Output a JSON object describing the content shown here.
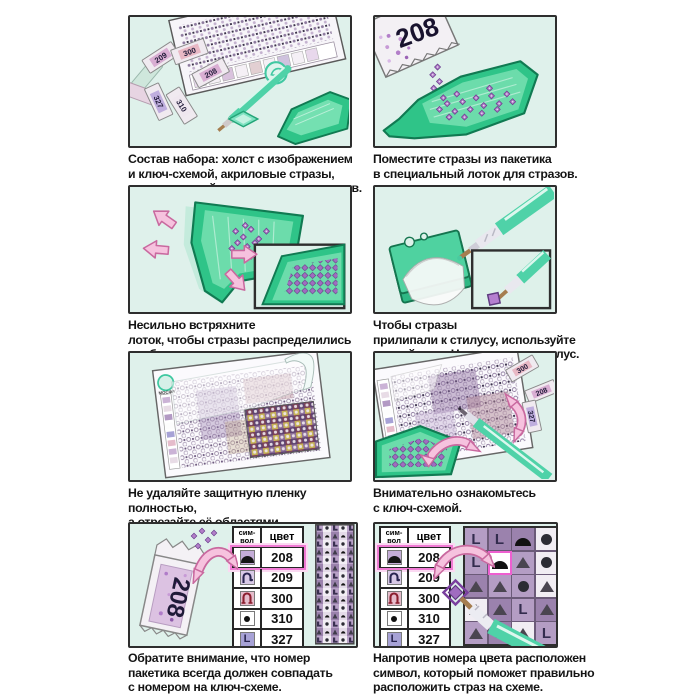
{
  "brand": "МОСФА",
  "panels": {
    "kit": {
      "caption": "Состав набора: холст с изображением\nи ключ-схемой, акриловые стразы,\nстилус, липкий гель, лоток для стразов."
    },
    "pour": {
      "caption": "Поместите стразы из пакетика\nв специальный лоток для стразов.",
      "packet_label": "208"
    },
    "shake": {
      "caption": "Несильно встряхните\nлоток, чтобы стразы распределились\nудобными рядами."
    },
    "gel": {
      "caption": "Чтобы стразы\nприлипали к стилусу, используйте\nлипкий гель. Наполните им стилус."
    },
    "film": {
      "caption": "Не удаляйте защитную пленку полностью,\nа отрезайте её областями.\nТак липкий слой прослужит дольше."
    },
    "study": {
      "caption": "Внимательно ознакомьтесь\nс ключ-схемой."
    },
    "match_number": {
      "caption": "Обратите внимание, что номер\nпакетика всегда должен совпадать\nс номером на ключ-схеме.",
      "packet_label": "208"
    },
    "place_symbol": {
      "caption": "Напротив номера цвета расположен\nсимвол, который поможет правильно\nрасположить страз на схеме."
    }
  },
  "kit_packets": [
    "209",
    "300",
    "208",
    "327",
    "310"
  ],
  "study_packets": [
    "300",
    "208",
    "327"
  ],
  "key_table": {
    "header_symbol": "сим-\nвол",
    "header_color": "цвет",
    "rows": [
      {
        "code": "208",
        "symbol": "dome-icon",
        "highlighted": true
      },
      {
        "code": "209",
        "symbol": "hook-icon",
        "highlighted": false
      },
      {
        "code": "300",
        "symbol": "arch-icon",
        "highlighted": false
      },
      {
        "code": "310",
        "symbol": "dot-icon",
        "highlighted": false
      },
      {
        "code": "327",
        "symbol": "letter-L",
        "letter": "L",
        "highlighted": false
      }
    ]
  },
  "schema_grid": {
    "cells": [
      [
        "L:m1",
        "L:m2",
        "dome:m2",
        "dot:w"
      ],
      [
        "L:m1",
        "dome:hl",
        "tri:m1",
        "dot:w"
      ],
      [
        "tri:m2",
        "tri:m1",
        "dot:m1",
        "tri:w"
      ],
      [
        "tri:w",
        "tri:m2",
        "L:m1",
        "tri:m2"
      ],
      [
        "tri:m1",
        "L:m2",
        "tri:w",
        "L:m1"
      ]
    ]
  },
  "colors": {
    "panel_bg": "#dff1eb",
    "tray_green": "#2fc488",
    "stylus_teal": "#4fd2a8",
    "crystal_purple": "#b37fc9",
    "highlight_pink": "#f07ad4",
    "arrow_pink": "#f6c2de"
  }
}
